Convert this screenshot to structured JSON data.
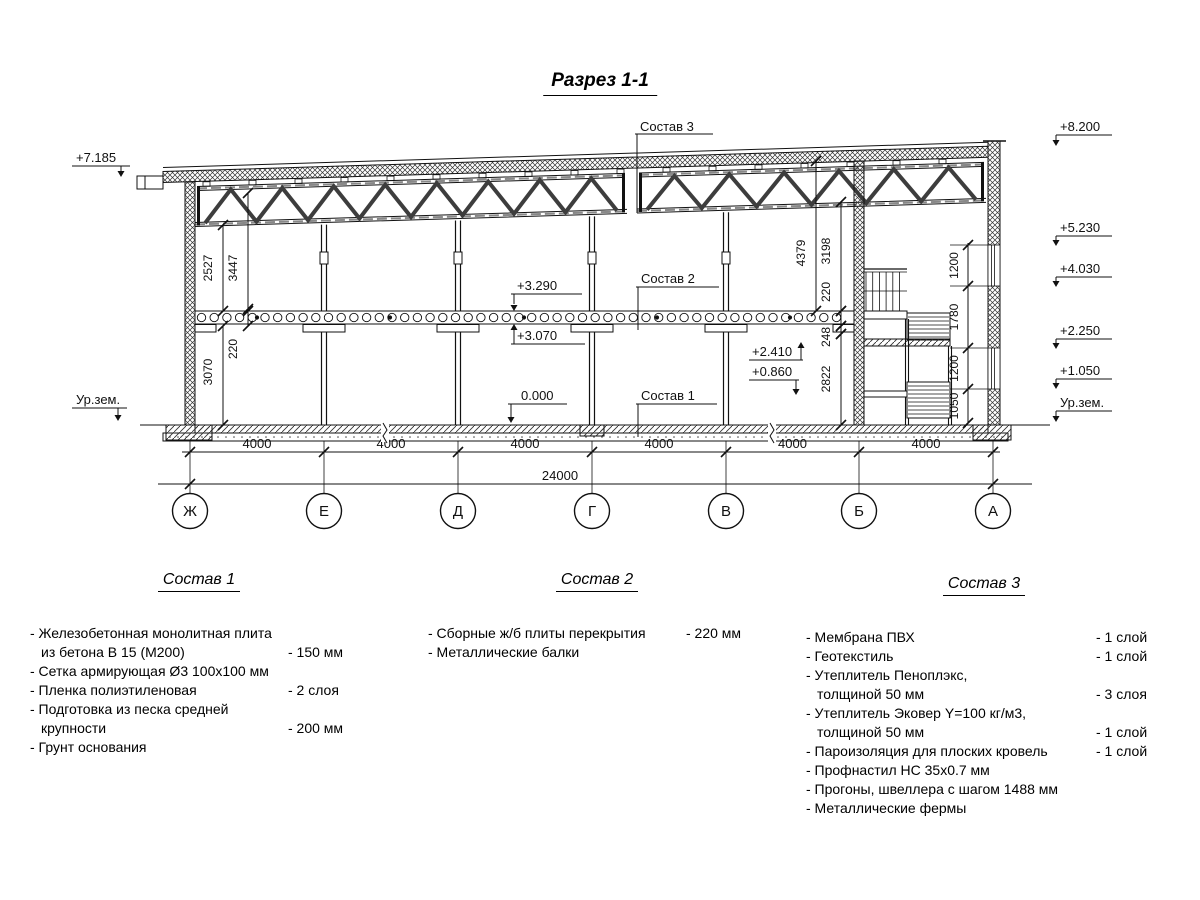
{
  "title": "Разрез 1-1",
  "marks_left": {
    "roof": "+7.185",
    "ground": "Ур.зем."
  },
  "marks_right": [
    "+8.200",
    "+5.230",
    "+4.030",
    "+2.250",
    "+1.050",
    "Ур.зем."
  ],
  "marks_inner": {
    "slab_top": "+3.290",
    "slab_bottom": "+3.070",
    "floor": "0.000",
    "landing_upper": "+2.410",
    "landing_lower": "+0.860"
  },
  "leaders": {
    "sostav1": "Состав 1",
    "sostav2": "Состав 2",
    "sostav3": "Состав 3"
  },
  "dims_left": [
    "2527",
    "3447",
    "220",
    "3070"
  ],
  "dims_right": [
    "4379",
    "3198",
    "220",
    "248",
    "2822"
  ],
  "dims_stair": [
    "1200",
    "1780",
    "1200",
    "1050"
  ],
  "dims_bottom": {
    "bays": [
      "4000",
      "4000",
      "4000",
      "4000",
      "4000",
      "4000"
    ],
    "total": "24000"
  },
  "axes": [
    "Ж",
    "Е",
    "Д",
    "Г",
    "В",
    "Б",
    "А"
  ],
  "legend": [
    {
      "heading": "Состав 1",
      "items": [
        {
          "lines": [
            "- Железобетонная  монолитная плита",
            "из бетона В 15 (М200)"
          ],
          "value": "- 150 мм"
        },
        {
          "lines": [
            "- Сетка армирующая Ø3 100х100 мм"
          ],
          "value": ""
        },
        {
          "lines": [
            "- Пленка полиэтиленовая"
          ],
          "value": "-  2 слоя"
        },
        {
          "lines": [
            "- Подготовка из песка средней",
            "крупности"
          ],
          "value": "- 200 мм"
        },
        {
          "lines": [
            "- Грунт основания"
          ],
          "value": ""
        }
      ]
    },
    {
      "heading": "Состав 2",
      "items": [
        {
          "lines": [
            "- Сборные ж/б плиты перекрытия"
          ],
          "value": "- 220 мм"
        },
        {
          "lines": [
            "- Металлические балки"
          ],
          "value": ""
        }
      ]
    },
    {
      "heading": "Состав 3",
      "items": [
        {
          "lines": [
            "- Мембрана ПВХ"
          ],
          "value": "- 1 слой"
        },
        {
          "lines": [
            "- Геотекстиль"
          ],
          "value": "- 1 слой"
        },
        {
          "lines": [
            "- Утеплитель Пеноплэкс,",
            "толщиной 50 мм"
          ],
          "value": "- 3 слоя"
        },
        {
          "lines": [
            "- Утеплитель Эковер Y=100 кг/м3,",
            "толщиной 50 мм"
          ],
          "value": "- 1 слой"
        },
        {
          "lines": [
            "- Пароизоляция для плоских кровель"
          ],
          "value": "- 1 слой"
        },
        {
          "lines": [
            "- Профнастил НС 35х0.7 мм"
          ],
          "value": ""
        },
        {
          "lines": [
            "- Прогоны, швеллера с шагом 1488 мм"
          ],
          "value": ""
        },
        {
          "lines": [
            "- Металлические фермы"
          ],
          "value": ""
        }
      ]
    }
  ]
}
